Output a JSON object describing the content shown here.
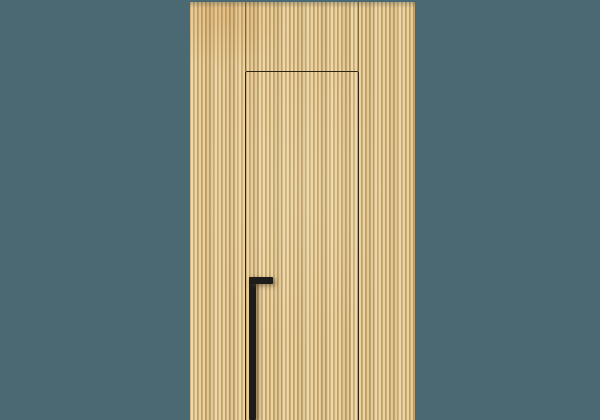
{
  "meta": {
    "description": "Concealed flush interior door integrated into a light oak vertical wood-slat wall panel, with a long matte black L-shaped pull handle, photographed on a muted slate-teal studio background.",
    "canvas": {
      "width": 600,
      "height": 420
    }
  },
  "colors": {
    "background": "#4b6972",
    "wood-base": "#e2c48c",
    "wood-slat-light": "#f0dcab",
    "wood-slat-mid": "#e6cb95",
    "wood-groove": "#b08c55",
    "wood-groove-dark": "#96713f",
    "seam": "#6b5226",
    "door-gap": "#2e2415",
    "handle": "#1d1c1a"
  },
  "geometry": {
    "panel": {
      "x": 190,
      "y": 2,
      "width": 225,
      "height": 418
    },
    "seam_left": {
      "x": 245,
      "y": 2,
      "width": 1,
      "height": 69
    },
    "seam_right": {
      "x": 358,
      "y": 2,
      "width": 1,
      "height": 69
    },
    "door": {
      "x": 244.5,
      "y": 71,
      "width": 114.5,
      "height": 349
    },
    "handle_vertical": {
      "x": 249,
      "y": 277,
      "width": 6.5,
      "height": 143
    },
    "handle_horizontal": {
      "x": 249,
      "y": 277,
      "width": 23.5,
      "height": 6.5
    }
  }
}
